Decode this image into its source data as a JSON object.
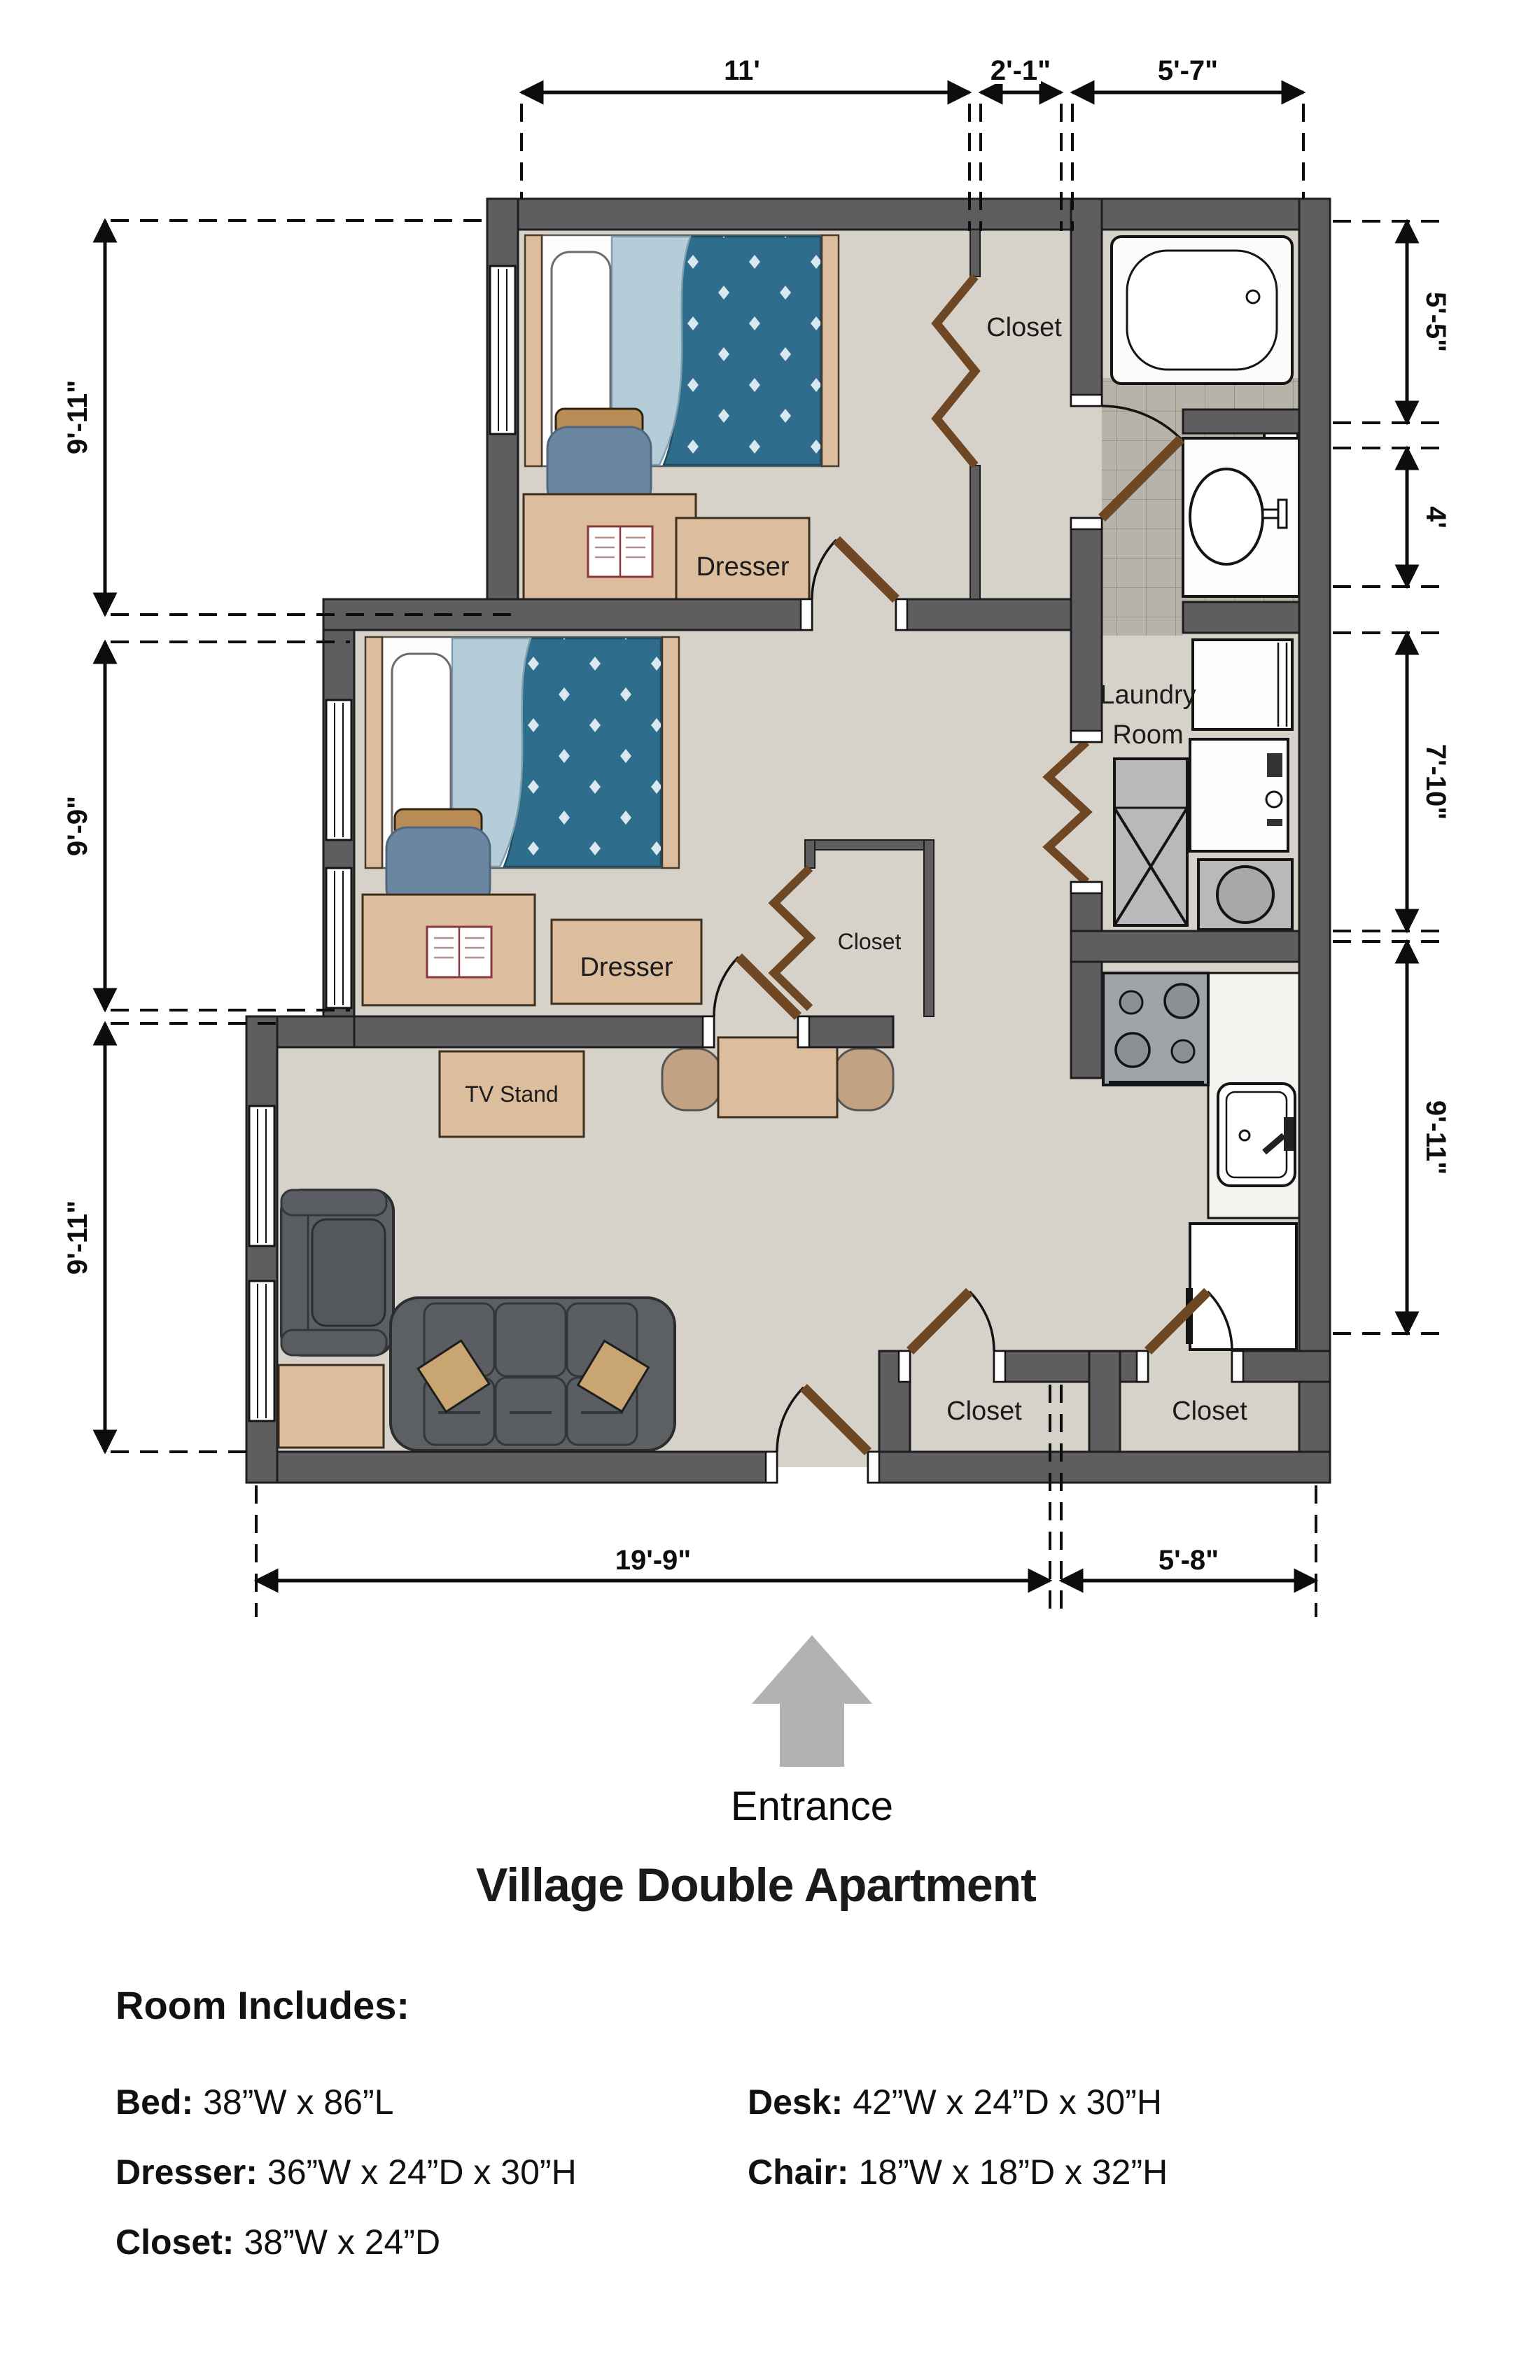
{
  "title": "Village Double Apartment",
  "plan": {
    "entrance_label": "Entrance",
    "room_labels": {
      "closet_top": "Closet",
      "laundry_line1": "Laundry",
      "laundry_line2": "Room",
      "closet_bedroom2": "Closet",
      "closet_entry_left": "Closet",
      "closet_entry_right": "Closet",
      "dresser_bedroom1": "Dresser",
      "dresser_bedroom2": "Dresser",
      "tv_stand": "TV Stand"
    },
    "dimensions": {
      "top_bedroom1": "11'",
      "top_closet": "2'-1\"",
      "top_bath": "5'-7\"",
      "left_bedroom1": "9'-11\"",
      "left_bedroom2": "9'-9\"",
      "left_living": "9'-11\"",
      "right_bath_tub": "5'-5\"",
      "right_vanity": "4'",
      "right_laundry": "7'-10\"",
      "right_kitchen": "9'-11\"",
      "bottom_main": "19'-9\"",
      "bottom_kitchen": "5'-8\""
    }
  },
  "legend": {
    "heading": "Room Includes:",
    "col1": [
      {
        "label": "Bed:",
        "value": "38”W x 86”L"
      },
      {
        "label": "Dresser:",
        "value": "36”W x 24”D x 30”H"
      },
      {
        "label": "Closet:",
        "value": "38”W x 24”D"
      }
    ],
    "col2": [
      {
        "label": "Desk:",
        "value": "42”W x 24”D x 30”H"
      },
      {
        "label": "Chair:",
        "value": "18”W x 18”D x 32”H"
      }
    ]
  },
  "colors": {
    "wall": "#5e5e61",
    "floor": "#d7d2c9",
    "tile": "#b7b3a9",
    "wood": "#dcbd9d",
    "door": "#6e4724",
    "blanket": "#2f6d8d",
    "sheet": "#b5cdd9",
    "chair": "#6a86a1",
    "sofa": "#5d6063",
    "pillow": "#c9a671",
    "arrow": "#b2b2b2"
  }
}
